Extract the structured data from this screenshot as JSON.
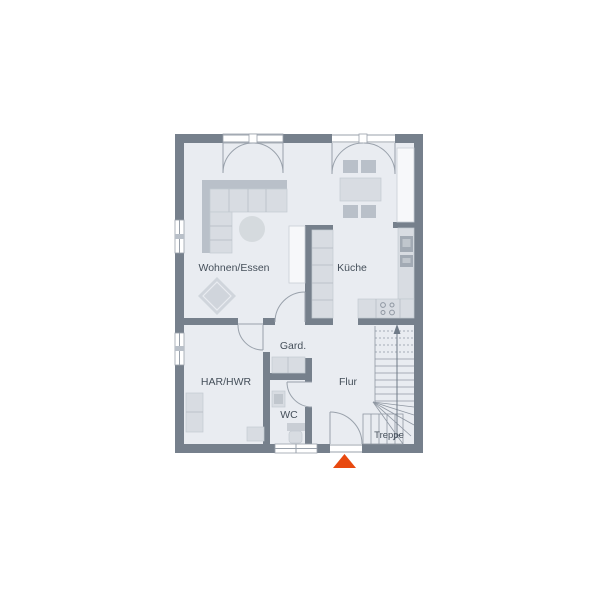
{
  "plan": {
    "type": "floor-plan-ground-floor",
    "rooms": [
      {
        "id": "wohnen-essen",
        "label": "Wohnen/Essen"
      },
      {
        "id": "kueche",
        "label": "Küche"
      },
      {
        "id": "gard",
        "label": "Gard."
      },
      {
        "id": "har-hwr",
        "label": "HAR/HWR"
      },
      {
        "id": "wc",
        "label": "WC"
      },
      {
        "id": "flur",
        "label": "Flur"
      },
      {
        "id": "treppe",
        "label": "Treppe"
      }
    ],
    "colors": {
      "wall": "#76808c",
      "floor": "#e9ecf1",
      "furniture_light": "#d8dce2",
      "furniture_mid": "#b9c0c9",
      "line": "#99a1ab",
      "text": "#454f5a",
      "accent_entrance": "#e8490f"
    },
    "entrance_marker": "triangle-up"
  }
}
